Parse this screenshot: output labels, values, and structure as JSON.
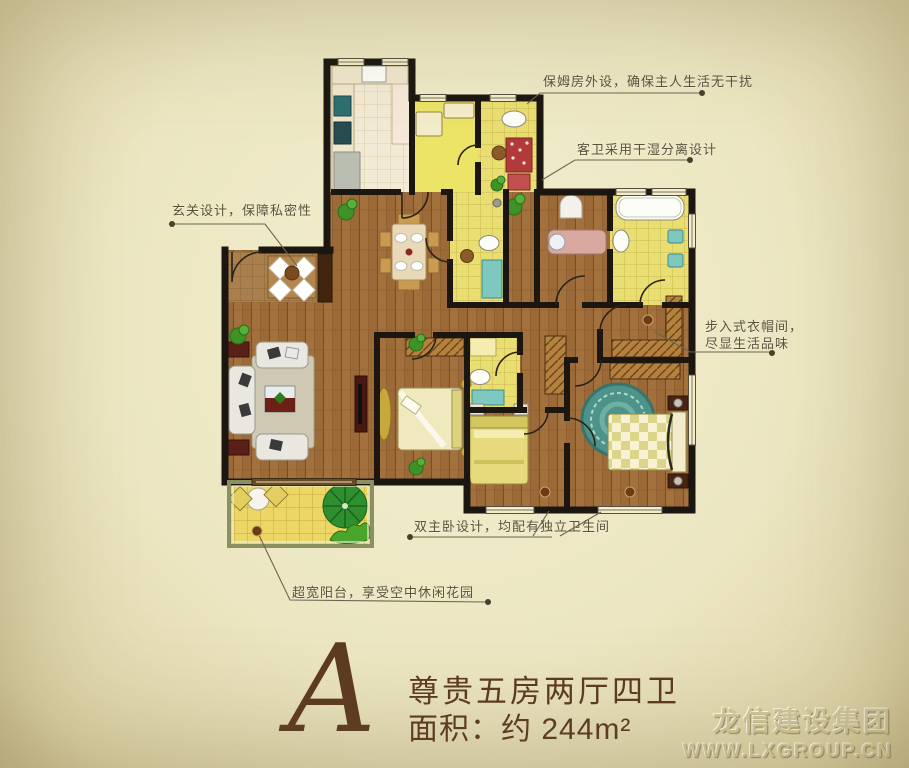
{
  "plan": {
    "letter": "A",
    "name": "尊贵五房两厅四卫",
    "area": "面积：约 244m²"
  },
  "annotations": {
    "maid_room": "保姆房外设，确保主人生活无干扰",
    "guest_bath": "客卫采用干湿分离设计",
    "entry": "玄关设计，保障私密性",
    "closet_line1": "步入式衣帽间，",
    "closet_line2": "尽显生活品味",
    "master": "双主卧设计，均配有独立卫生间",
    "balcony": "超宽阳台，享受空中休闲花园"
  },
  "logo": {
    "company": "龙信建设集团",
    "website": "WWW.LXGROUP.CN"
  },
  "colors": {
    "background": "#ece6c2",
    "wall": "#1b1710",
    "wood_floor": "#9c6a38",
    "tile_yellow": "#e9de72",
    "kitchen_tile": "#f2ead4",
    "balcony_tile": "#ecd766",
    "entry_tile": "#a97f4d",
    "title_brown": "#5d3a22",
    "annotation_text": "#5c523c",
    "logo_emboss": "#d2c99c",
    "plant_green": "#3f9326",
    "rug_teal": "#4e938a",
    "red_cabinet": "#b33a3a"
  }
}
